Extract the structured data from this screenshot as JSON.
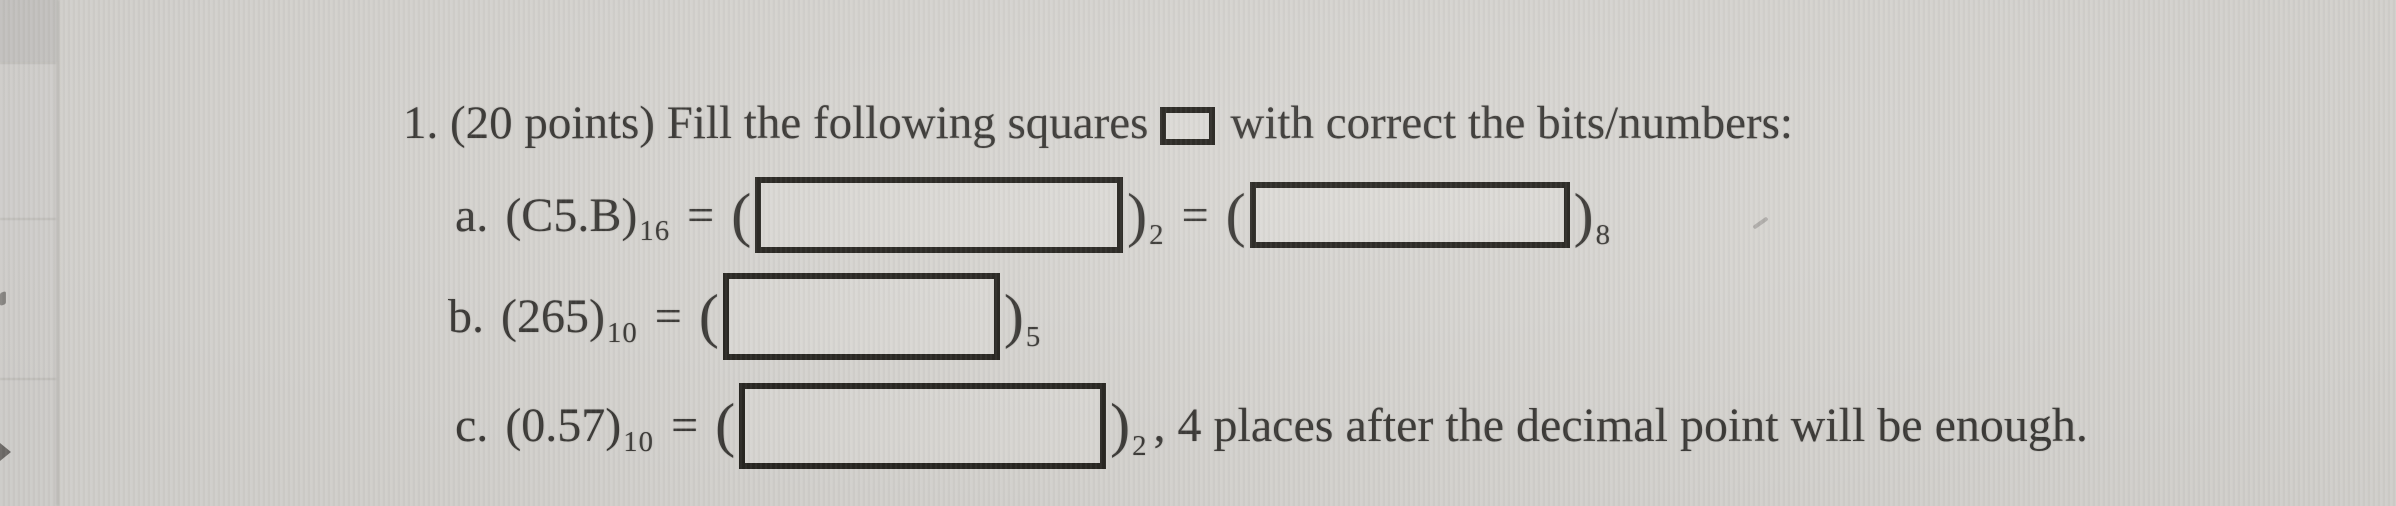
{
  "colors": {
    "page_background": "#d7d5d1",
    "text": "#3a3835",
    "box_border": "#26241f",
    "side_strip": "#d4d2cf"
  },
  "icons": {
    "square_symbol": "empty-square-outline"
  },
  "problem": {
    "title_before_square": "1. (20 points) Fill the following squares",
    "title_after_square": "with correct the bits/numbers:",
    "parts": {
      "a": {
        "label": "a.",
        "given": "(C5.B)",
        "given_base": "16",
        "eq1": "=",
        "open1": "(",
        "close1": ")",
        "result_base1": "2",
        "eq2": "=",
        "open2": "(",
        "close2": ")",
        "result_base2": "8"
      },
      "b": {
        "label": "b.",
        "given": "(265)",
        "given_base": "10",
        "eq": "=",
        "open": "(",
        "close": ")",
        "result_base": "5"
      },
      "c": {
        "label": "c.",
        "given": "(0.57)",
        "given_base": "10",
        "eq": "=",
        "open": "(",
        "close": ")",
        "result_base": "2",
        "note": ", 4 places after the decimal point will be enough."
      }
    }
  }
}
